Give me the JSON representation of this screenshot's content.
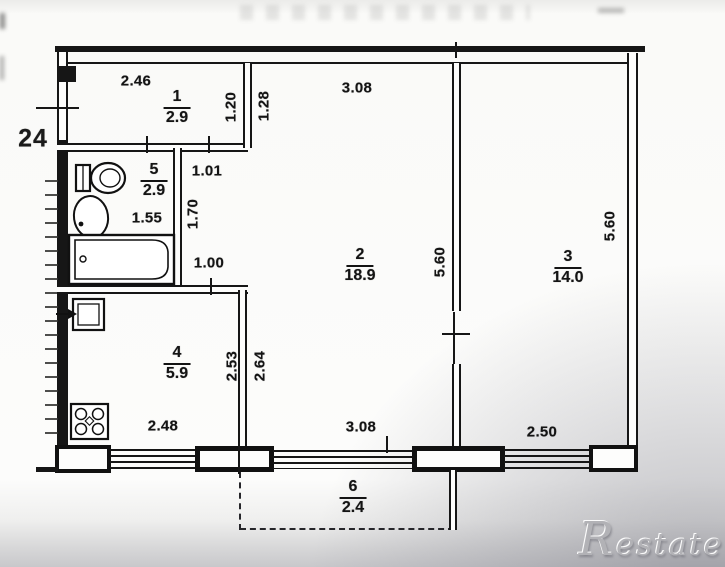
{
  "apartment": {
    "unit_number": "24",
    "rooms": [
      {
        "number": "1",
        "area": "2.9"
      },
      {
        "number": "2",
        "area": "18.9"
      },
      {
        "number": "3",
        "area": "14.0"
      },
      {
        "number": "4",
        "area": "5.9"
      },
      {
        "number": "5",
        "area": "2.9"
      },
      {
        "number": "6",
        "area": "2.4"
      }
    ],
    "dimensions": {
      "hall_top_width": "2.46",
      "room2_top_width": "3.08",
      "niche_depth_left": "1.20",
      "niche_depth_right": "1.28",
      "corridor_width": "1.01",
      "corridor_length": "1.70",
      "bath_width": "1.55",
      "kitchen_entry_width": "1.00",
      "room2_side_depth": "5.60",
      "room3_side_depth": "5.60",
      "kitchen_depth_inner": "2.53",
      "room2_left_depth": "2.64",
      "kitchen_bottom_width": "2.48",
      "room2_window_width": "3.08",
      "room3_window_width": "2.50"
    },
    "fixtures": [
      "toilet",
      "washbasin",
      "bathtub",
      "kitchen-sink",
      "stove"
    ]
  },
  "watermark": {
    "text": "Restate"
  },
  "colors": {
    "line": "#161616",
    "paper": "#fcfcfb",
    "watermark_gray": "#b2b2b6"
  }
}
